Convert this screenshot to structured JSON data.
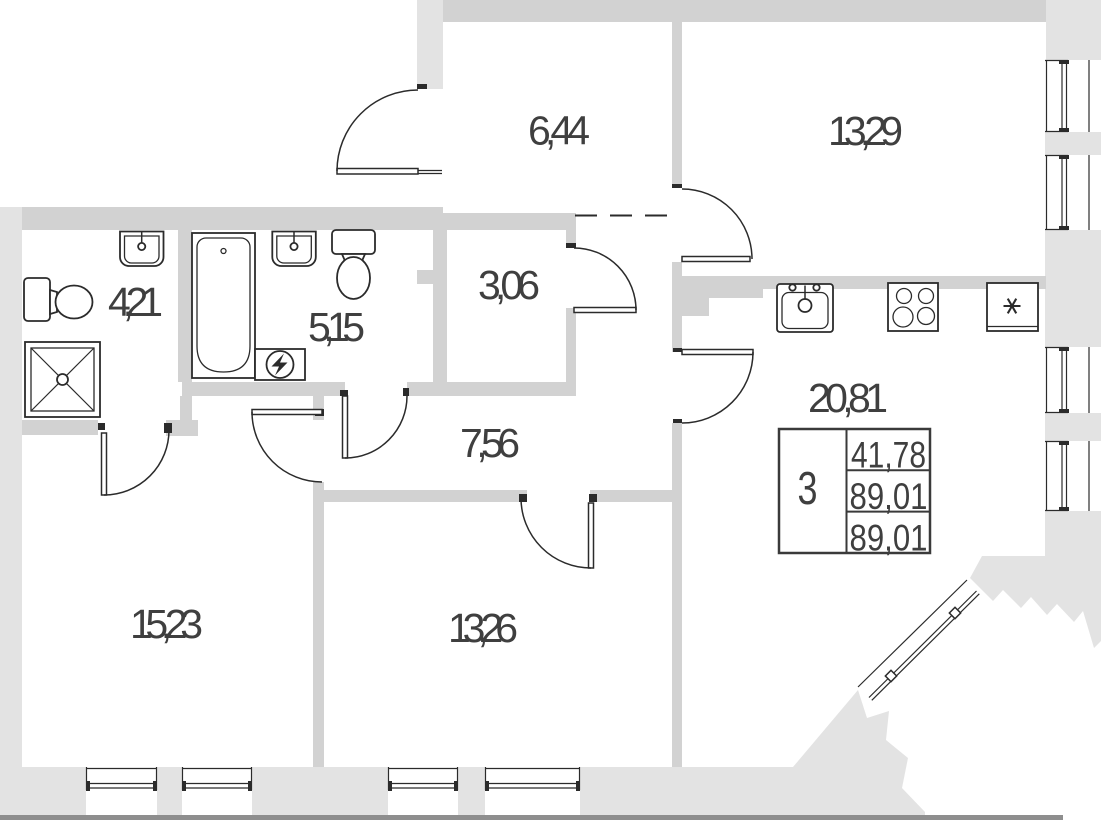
{
  "rooms": {
    "hall": {
      "area": "6,44"
    },
    "bedroom_top": {
      "area": "13,29"
    },
    "bathroom_small": {
      "area": "4,21"
    },
    "bathroom_large": {
      "area": "5,15"
    },
    "wardrobe": {
      "area": "3,06"
    },
    "corridor": {
      "area": "7,56"
    },
    "kitchen_living": {
      "area": "20,81"
    },
    "bedroom_left": {
      "area": "15,23"
    },
    "bedroom_center": {
      "area": "13,26"
    }
  },
  "info_table": {
    "rooms_count": "3",
    "row1": "41,78",
    "row2": "89,01",
    "row3": "89,01"
  },
  "icons": [
    "toilet-icon",
    "sink-icon",
    "shower-icon",
    "bathtub-icon",
    "water-heater-icon",
    "kitchen-sink-icon",
    "stove-icon",
    "fridge-icon",
    "window-icon",
    "door-icon"
  ],
  "colors": {
    "wall": "#d2d2d2",
    "wall_exterior": "#e3e3e3",
    "line": "#2b2b2b",
    "outer_edge": "#8e8e8e",
    "text": "#3f3f3f"
  }
}
